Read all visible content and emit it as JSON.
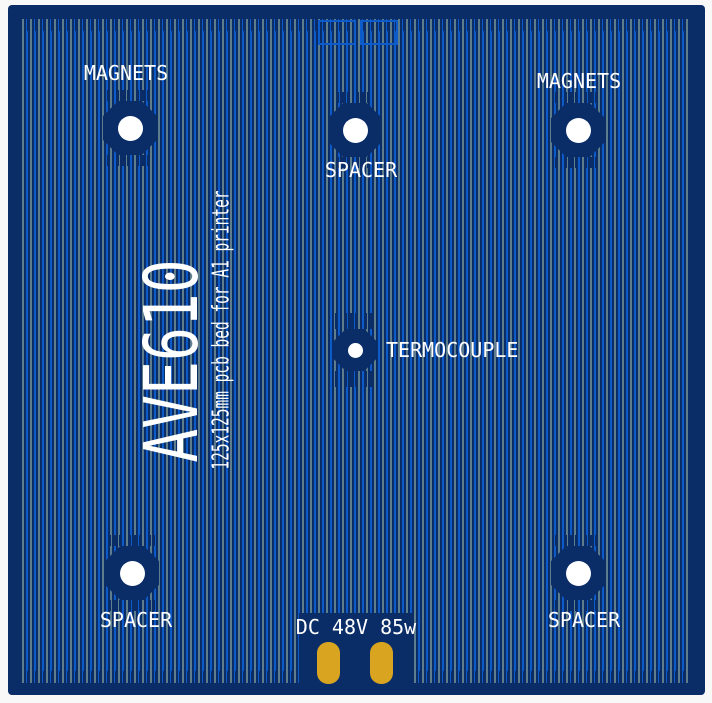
{
  "pcb": {
    "title": "AVE610",
    "subtitle": "125x125mm pcb bed for A1 printer",
    "power_rating": "DC 48V 85w",
    "mount_points": [
      {
        "id": "top-left",
        "label": "MAGNETS"
      },
      {
        "id": "top-center",
        "label": "SPACER"
      },
      {
        "id": "top-right",
        "label": "MAGNETS"
      },
      {
        "id": "center",
        "label": "TERMOCOUPLE"
      },
      {
        "id": "bottom-left",
        "label": "SPACER"
      },
      {
        "id": "bottom-right",
        "label": "SPACER"
      }
    ],
    "colors": {
      "board_navy": "#0a2d68",
      "trace_blue": "#0d5ac9",
      "trace_gray": "#5f7e8d",
      "pad_gold": "#d9a420",
      "hole_white": "#ffffff",
      "silkscreen_white": "#ffffff",
      "page_background": "#f8f8f8"
    }
  }
}
